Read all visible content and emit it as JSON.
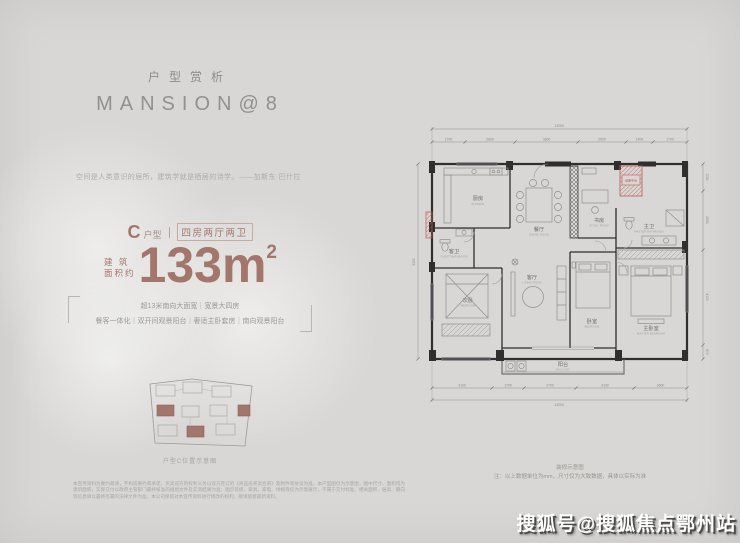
{
  "colors": {
    "accent": "#a3766b",
    "background": "#d8d7d5",
    "equip_red": "#b5524a"
  },
  "header": {
    "subtitle": "户型赏析",
    "title": "MANSION@8"
  },
  "quote": "空间是人类意识的居所，建筑学就是栖居的诗学。——加斯东·巴什拉",
  "unit": {
    "type_letter": "C",
    "type_label": "户型",
    "layout": "四房两厅两卫",
    "area_label_top": "建 筑",
    "area_label_bottom": "面积约",
    "area_value": "133m",
    "area_sup": "2"
  },
  "features": {
    "line1": "超13米南向大面宽｜宽景大四房",
    "line2": "餐客一体化｜双开间观景阳台｜奢适主卧套房｜南向观景阳台"
  },
  "keyplan": {
    "caption": "户型C位置示意图"
  },
  "disclaimer": "本宣传资料为要约邀请，不构成要约或承诺，买卖双方的权利义务以双方签订的《商品房买卖合同》及附件等协议为准。本户型图仅为示意图，图中尺寸、面积均为建筑面积，实际交付以政府主管部门最终核准的规划文件及实测结果为准；图示装修、家具、家电、绿植等仅为示意展示，不属于交付标准。相关面积、层高、朝向等信息请以最终签署的法律文件为准。本公司保留对本宣传资料进行修改的权利，敬请留意最新资料。",
  "floorplan": {
    "dims_top": {
      "total": "13200",
      "segments": [
        "1700",
        "2600",
        "3300",
        "2500",
        "1400",
        "1700"
      ]
    },
    "dims_bottom": {
      "total": "13200",
      "segments": [
        "3100",
        "1700",
        "2700",
        "3100",
        "2600"
      ]
    },
    "dims_left": {
      "segments": [
        "3350"
      ]
    },
    "dims_right": {
      "segments": [
        "1150",
        "2550",
        "4100",
        "600"
      ]
    },
    "rooms": {
      "kitchen": {
        "zh": "厨房",
        "en": "KITCHEN"
      },
      "guest_bath": {
        "zh": "客卫",
        "en": "GUEST BATHROOM"
      },
      "dining": {
        "zh": "餐厅",
        "en": "DINING ROOM"
      },
      "study": {
        "zh": "书房",
        "en": "STUDY ROOM"
      },
      "living": {
        "zh": "客厅",
        "en": "LIVING ROOM"
      },
      "bedroom2": {
        "zh": "卧室",
        "en": "BEDROOM"
      },
      "master_bedroom": {
        "zh": "主卧室",
        "en": "MASTER BEDROOM"
      },
      "master_bath": {
        "zh": "主卫",
        "en": "MASTER BATHROOM"
      },
      "bedroom3": {
        "zh": "次卧",
        "en": "BEDROOM"
      },
      "balcony": {
        "zh": "阳台",
        "en": "BALCONY"
      },
      "equip": {
        "zh": "设备平台"
      }
    },
    "notes": {
      "line1": "装修示意图",
      "line2": "注：以上数据单位为mm，尺寸仅为大致数据，具体以实际为准"
    }
  },
  "watermark": "搜狐号@搜狐焦点鄂州站"
}
